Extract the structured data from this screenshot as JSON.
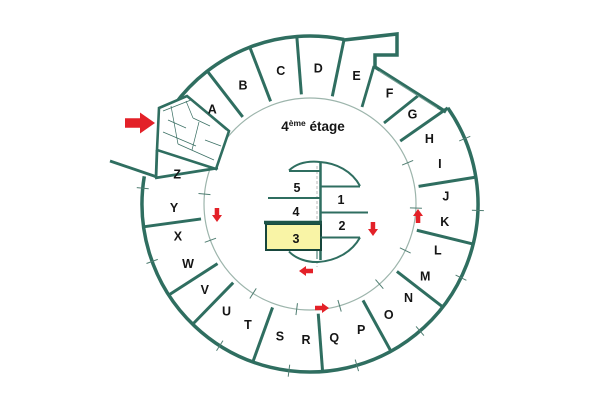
{
  "title": {
    "number": "4",
    "superscript": "ème",
    "word": "étage"
  },
  "colors": {
    "wall": "#2f6e60",
    "wall_dark": "#1d5448",
    "thin_line": "#9db5ac",
    "tick": "#4f7d71",
    "detail": "#3a6f63",
    "stairs_hint": "#7da399",
    "dashed": "#b3b3b3",
    "highlight_fill": "#f9f4a6",
    "highlight_border": "#17463c",
    "arrow_red": "#e32128",
    "text": "#151515",
    "background": "#ffffff"
  },
  "plan": {
    "canvas": {
      "w": 600,
      "h": 400
    },
    "center": {
      "x": 310,
      "y": 204
    },
    "radii": {
      "outer": 168,
      "inner_circle": 106,
      "room_inner": 110,
      "label": 136
    },
    "ring_rooms": [
      {
        "label": "A",
        "angle": 135.9
      },
      {
        "label": "B",
        "angle": 119.5
      },
      {
        "label": "C",
        "angle": 102.4
      },
      {
        "label": "D",
        "angle": 86.5
      },
      {
        "label": "E",
        "angle": 70.0
      },
      {
        "label": "F",
        "angle": 54.2
      },
      {
        "label": "G",
        "angle": 41.1
      },
      {
        "label": "H",
        "angle": 28.6
      },
      {
        "label": "I",
        "angle": 17.2
      },
      {
        "label": "J",
        "angle": 3.2
      },
      {
        "label": "K",
        "angle": -7.6
      },
      {
        "label": "L",
        "angle": -20.0
      },
      {
        "label": "M",
        "angle": -32.1
      },
      {
        "label": "N",
        "angle": -43.6
      },
      {
        "label": "O",
        "angle": -54.6
      },
      {
        "label": "P",
        "angle": -67.9
      },
      {
        "label": "Q",
        "angle": -79.7
      },
      {
        "label": "R",
        "angle": -91.7
      },
      {
        "label": "S",
        "angle": -102.8
      },
      {
        "label": "T",
        "angle": -117.1
      },
      {
        "label": "U",
        "angle": -127.9
      },
      {
        "label": "V",
        "angle": -140.7
      },
      {
        "label": "W",
        "angle": -153.8
      },
      {
        "label": "X",
        "angle": -166.2
      },
      {
        "label": "Y",
        "angle": -178.3
      },
      {
        "label": "Z",
        "angle": 167.5
      }
    ],
    "outer_arcs": [
      {
        "from": 144.0,
        "to": 78.3,
        "large": 0
      },
      {
        "from": 34.9,
        "to": -189.5,
        "large": 1
      }
    ],
    "notch_path": [
      [
        344,
        40
      ],
      [
        397,
        34
      ],
      [
        397,
        55
      ],
      [
        375,
        55
      ],
      [
        375,
        67
      ],
      [
        446,
        112
      ]
    ],
    "radial_wall_angles": [
      127.7,
      111.0,
      94.5,
      78.3,
      34.9,
      9.2,
      -13.8,
      -37.8,
      -61.2,
      -85.7,
      -109.9,
      -134.3,
      -147.2,
      -172.2
    ],
    "custom_walls": [
      [
        362,
        107,
        374,
        66
      ],
      [
        384,
        123,
        419,
        95
      ],
      [
        155,
        178,
        218,
        168
      ],
      [
        221,
        140,
        227,
        131
      ],
      [
        110,
        161,
        157,
        177
      ],
      [
        157,
        150,
        156,
        178
      ]
    ],
    "tick_angles": [
      -185.4,
      -160.0,
      -122.5,
      -97.2,
      -73.8,
      -49.1,
      -26.0,
      -2.2,
      22.9
    ],
    "stairs_hint": [
      379,
      71,
      437,
      108
    ],
    "entrance": {
      "outline": [
        [
          159,
          108
        ],
        [
          187,
          96
        ],
        [
          229,
          131
        ],
        [
          216,
          169
        ],
        [
          157,
          150
        ]
      ],
      "detail_lines": [
        [
          163,
          111,
          191,
          100
        ],
        [
          191,
          100,
          226,
          130
        ],
        [
          171,
          106,
          178,
          144
        ],
        [
          178,
          144,
          214,
          160
        ],
        [
          163,
          132,
          196,
          146
        ],
        [
          186,
          101,
          193,
          118
        ],
        [
          193,
          118,
          210,
          126
        ],
        [
          199,
          122,
          192,
          150
        ],
        [
          205,
          140,
          221,
          146
        ],
        [
          168,
          120,
          186,
          128
        ]
      ]
    },
    "core": {
      "spine": [
        320.5,
        162,
        320.5,
        260
      ],
      "dashed_line": [
        317,
        166,
        317,
        267
      ],
      "top_fan_arc": "M289,170.5 C298,162 310,161 320,162 C336,163 352,171 360,186",
      "top_left_shelf": [
        289,
        171,
        320.5,
        171
      ],
      "top_right_shelf": [
        320.5,
        186.5,
        360,
        186.5
      ],
      "divider_5_4": [
        268,
        198,
        320.5,
        198
      ],
      "divider_1_2": [
        320.5,
        212.5,
        368,
        212.5
      ],
      "room3_rect": [
        266,
        224,
        55,
        26
      ],
      "room3_top_edge": [
        264,
        222.5,
        322,
        222.5
      ],
      "bottom_right_shelf": [
        320.5,
        237.5,
        360,
        237.5
      ],
      "bottom_fan_arc": "M289,251.5 C296,259 308,262.5 318,262 C336,261 352,252 360,237.5",
      "bottom_tick": [
        317,
        251,
        317,
        259
      ],
      "rooms": [
        {
          "label": "5",
          "x": 297,
          "y": 188,
          "highlight": false
        },
        {
          "label": "4",
          "x": 296,
          "y": 212,
          "highlight": false
        },
        {
          "label": "3",
          "x": 296,
          "y": 239,
          "highlight": true
        },
        {
          "label": "1",
          "x": 341,
          "y": 200,
          "highlight": false
        },
        {
          "label": "2",
          "x": 342,
          "y": 226,
          "highlight": false
        }
      ]
    },
    "title_pos": {
      "x": 313,
      "y": 131
    },
    "arrows": [
      {
        "name": "entrance-arrow",
        "cx": 140,
        "cy": 123,
        "dir": "right",
        "len": 30,
        "girth": 21
      },
      {
        "name": "corridor-arrow-left-down",
        "cx": 217,
        "cy": 215,
        "dir": "down",
        "len": 14,
        "girth": 10
      },
      {
        "name": "corridor-arrow-right-up",
        "cx": 418,
        "cy": 216,
        "dir": "up",
        "len": 14,
        "girth": 10
      },
      {
        "name": "core-arrow-right-down",
        "cx": 373,
        "cy": 229,
        "dir": "down",
        "len": 14,
        "girth": 10
      },
      {
        "name": "core-arrow-bottom-left",
        "cx": 306,
        "cy": 271,
        "dir": "left",
        "len": 14,
        "girth": 10
      },
      {
        "name": "corridor-arrow-bottom-right",
        "cx": 322,
        "cy": 308,
        "dir": "right",
        "len": 14,
        "girth": 10
      }
    ]
  }
}
